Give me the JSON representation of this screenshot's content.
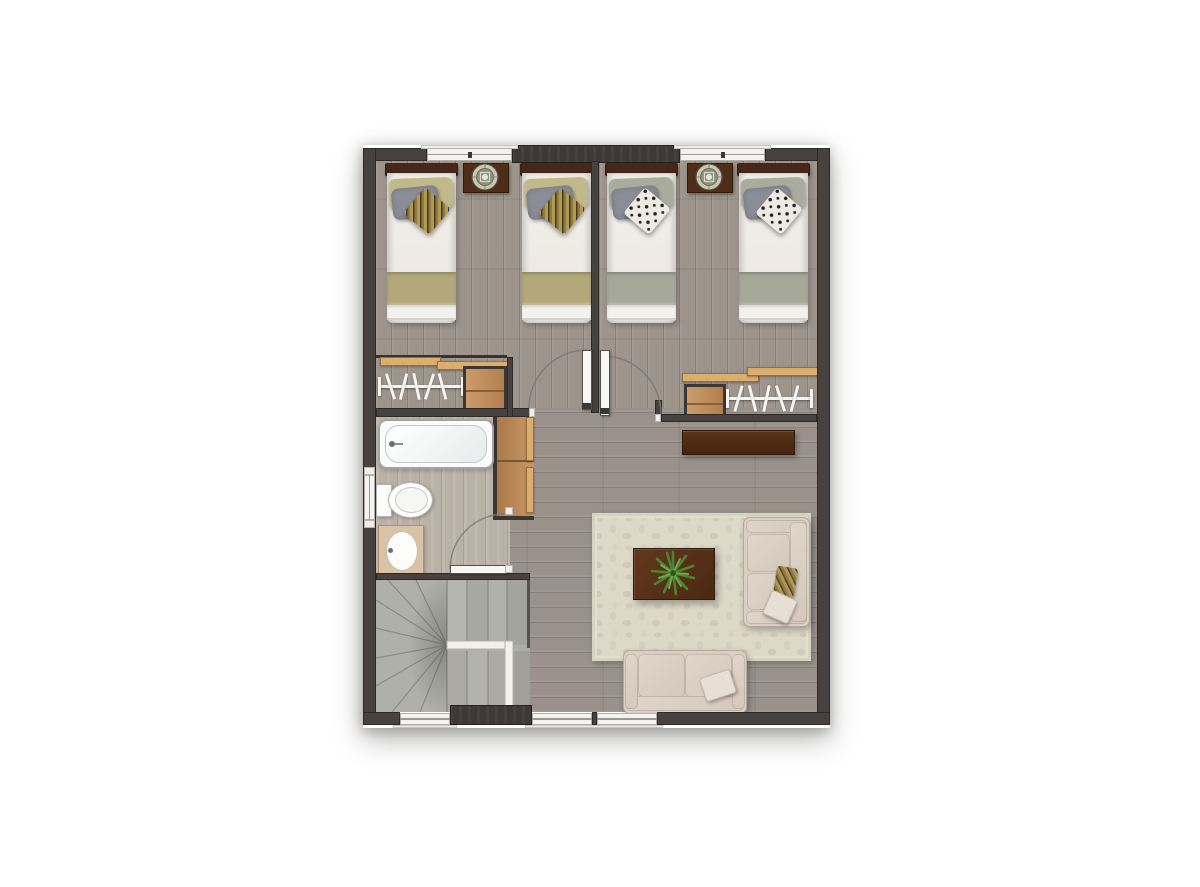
{
  "scene": {
    "type": "floor-plan-rendering",
    "view": "top-down",
    "rooms": [
      {
        "name": "bedroom-left",
        "furniture": [
          "twin-bed",
          "twin-bed",
          "nightstand-with-round-lamp",
          "reach-in-closet-with-rod-and-shelf"
        ],
        "bedding": {
          "duvet": "white",
          "foot_blanket": "#b2a87c",
          "pillows": [
            "khaki",
            "gray",
            "gold-patterned"
          ]
        },
        "windows": 1
      },
      {
        "name": "bedroom-right",
        "furniture": [
          "twin-bed",
          "twin-bed",
          "nightstand-with-round-lamp",
          "reach-in-closet-with-rod-and-shelf"
        ],
        "bedding": {
          "duvet": "white",
          "foot_blanket": "#a6a89a",
          "pillows": [
            "sage",
            "gray",
            "black-white-patterned"
          ]
        },
        "windows": 1
      },
      {
        "name": "bathroom",
        "fixtures": [
          "bathtub",
          "toilet",
          "sink-vanity"
        ],
        "storage": [
          "linen-shelf-unit"
        ],
        "windows": 1
      },
      {
        "name": "stairwell",
        "stairs": "u-shaped-winder",
        "railing": "white-l-shaped"
      },
      {
        "name": "living-area",
        "furniture": [
          "area-rug",
          "coffee-table",
          "potted-plant",
          "sofa",
          "loveseat",
          "console-dresser"
        ],
        "windows": 3
      }
    ],
    "doors": [
      "bedroom-left-door-open",
      "bedroom-right-door-open",
      "bathroom-door-open"
    ],
    "counts": {
      "beds": 4,
      "nightstands": 2,
      "closets": 2,
      "hangers_per_closet": 5
    }
  },
  "palette": {
    "wall": "#474140",
    "bedroom_floor": "#9d948c",
    "living_floor": "#99918a",
    "bathroom_floor": "#bab2a7",
    "stairs": "#aeaea8",
    "rug": "#ded8c9",
    "closet_wood": "#c18a52",
    "dark_furniture": "#4f2d18",
    "duvet_white": "#f2efe9",
    "blanket_olive": "#b2a87c",
    "blanket_sage": "#a6a89a",
    "pillow_gray": "#8a8d97",
    "sofa_beige": "#dbcfc4",
    "plant_green": "#4a8534",
    "fixture_white": "#fbfbfa",
    "window_white": "#f4f3f1"
  }
}
